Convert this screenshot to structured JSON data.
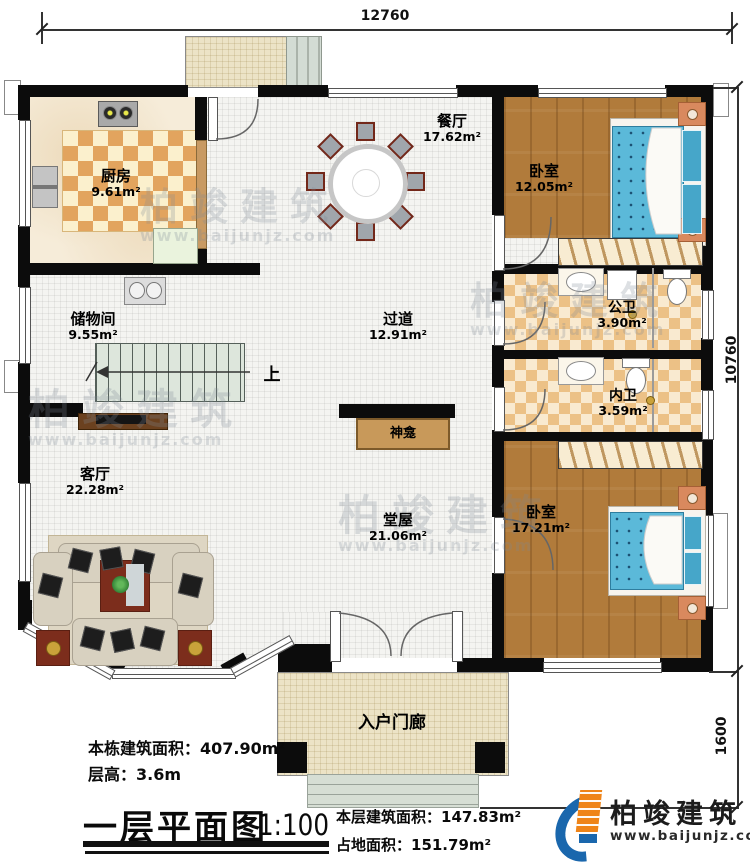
{
  "plan": {
    "dimensions": {
      "width_top": "12760",
      "height_main": "10760",
      "porch_depth": "1600"
    },
    "rooms": {
      "kitchen": {
        "name": "厨房",
        "area": "9.61m²"
      },
      "dining": {
        "name": "餐厅",
        "area": "17.62m²"
      },
      "bedroom_top": {
        "name": "卧室",
        "area": "12.05m²"
      },
      "storage": {
        "name": "储物间",
        "area": "9.55m²"
      },
      "hallway": {
        "name": "过道",
        "area": "12.91m²"
      },
      "public_bath": {
        "name": "公卫",
        "area": "3.90m²"
      },
      "private_bath": {
        "name": "内卫",
        "area": "3.59m²"
      },
      "living": {
        "name": "客厅",
        "area": "22.28m²"
      },
      "hall": {
        "name": "堂屋",
        "area": "21.06m²"
      },
      "bedroom_bottom": {
        "name": "卧室",
        "area": "17.21m²"
      },
      "entry_porch": {
        "name": "入户门廊"
      },
      "shrine": {
        "name": "神龛"
      },
      "stairs": {
        "up_label": "上"
      }
    }
  },
  "title_block": {
    "building_area": "本栋建筑面积：407.90m²",
    "floor_height": "层高：3.6m",
    "plan_title": "一层平面图",
    "scale": "1:100",
    "floor_area": "本层建筑面积：147.83m²",
    "footprint_area": "占地面积：151.79m²"
  },
  "branding": {
    "logo_text": "柏竣建筑",
    "logo_url": "www.baijunjz.com"
  },
  "watermark": {
    "text": "柏竣建筑",
    "url": "www.baijunjz.com"
  }
}
